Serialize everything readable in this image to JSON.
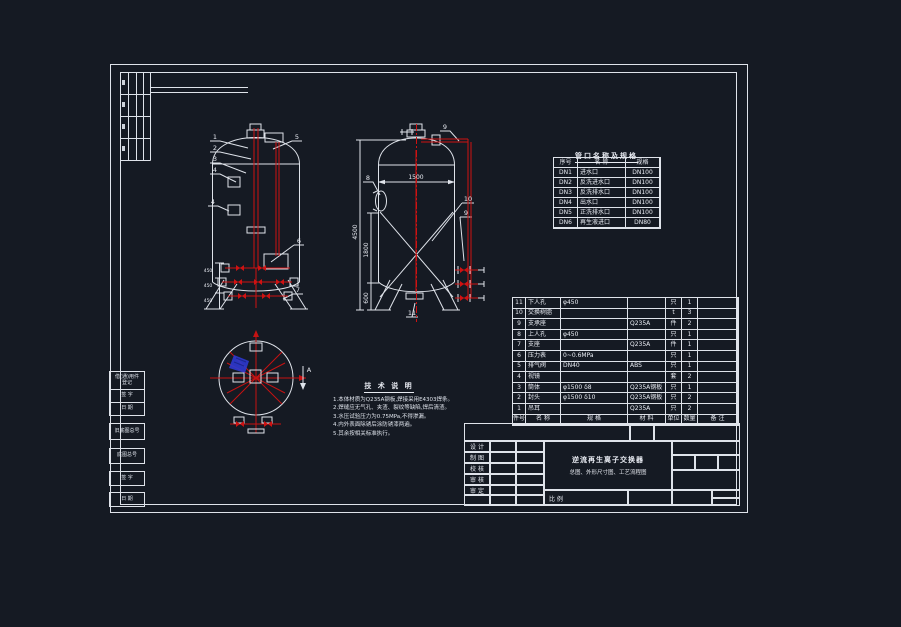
{
  "colors": {
    "background": "#151a23",
    "line": "#dfe3ea",
    "red": "#cf1212",
    "blue": "#2c38cf"
  },
  "nozzle_table": {
    "title": "管口名称及规格",
    "headers": [
      "序号",
      "名 称",
      "规格"
    ],
    "rows": [
      [
        "DN1",
        "进水口",
        "DN100"
      ],
      [
        "DN2",
        "反洗进水口",
        "DN100"
      ],
      [
        "DN3",
        "反洗排水口",
        "DN100"
      ],
      [
        "DN4",
        "出水口",
        "DN100"
      ],
      [
        "DN5",
        "正洗排水口",
        "DN100"
      ],
      [
        "DN6",
        "再生液进口",
        "DN80"
      ]
    ]
  },
  "bom": {
    "headers": [
      "件号",
      "名 称",
      "规 格",
      "材 料",
      "单位",
      "数量",
      "备 注"
    ],
    "rows": [
      [
        "11",
        "下人孔",
        "φ450",
        "",
        "只",
        "1",
        ""
      ],
      [
        "10",
        "交换树脂",
        "",
        "",
        "t",
        "3",
        ""
      ],
      [
        "9",
        "支承座",
        "",
        "Q235A",
        "件",
        "2",
        ""
      ],
      [
        "8",
        "上人孔",
        "φ450",
        "",
        "只",
        "1",
        ""
      ],
      [
        "7",
        "支座",
        "",
        "Q235A",
        "件",
        "1",
        ""
      ],
      [
        "6",
        "压力表",
        "0~0.6MPa",
        "",
        "只",
        "1",
        ""
      ],
      [
        "5",
        "排气阀",
        "DN40",
        "ABS",
        "只",
        "1",
        ""
      ],
      [
        "4",
        "视镜",
        "",
        "",
        "套",
        "2",
        ""
      ],
      [
        "3",
        "筒体",
        "φ1500 δ8",
        "Q235A钢板",
        "只",
        "1",
        ""
      ],
      [
        "2",
        "封头",
        "φ1500 δ10",
        "Q235A钢板",
        "只",
        "2",
        ""
      ],
      [
        "1",
        "吊耳",
        "",
        "Q235A",
        "只",
        "2",
        ""
      ]
    ]
  },
  "notes": {
    "title": "技 术 说 明",
    "lines": [
      "1.本体材质为Q235A钢板,焊接采用E4303焊条。",
      "2.焊缝应无气孔、夹渣、裂纹等缺陷,焊后清渣。",
      "3.水压试验压力为0.75MPa,不得渗漏。",
      "4.内外表面除锈后涂防锈漆两遍。",
      "5.其余按相关标准执行。"
    ]
  },
  "title_block": {
    "roles": [
      "设 计",
      "制 图",
      "校 核",
      "审 核",
      "审 定"
    ],
    "title_line1": "逆流再生离子交换器",
    "title_line2": "总图、外形尺寸图、工艺流程图",
    "scale_label": "比 例"
  },
  "margin_strip": {
    "rows": [
      "借(通)用件",
      "登记",
      "签 字",
      "日 期",
      "旧底图总号",
      "底图总号",
      "签 字",
      "日 期"
    ]
  },
  "drawing": {
    "dims": {
      "diameter": "1500",
      "total_height": "4500",
      "mid_height": "1800",
      "leg_height": "600",
      "spacing": "450"
    },
    "balloons": {
      "b1": "1",
      "b2": "2",
      "b3": "3",
      "b4": "4",
      "b5": "5",
      "b6": "6",
      "b7": "7",
      "b8": "8",
      "b9": "9",
      "b10": "10",
      "b11": "11"
    },
    "section_label": "A"
  }
}
